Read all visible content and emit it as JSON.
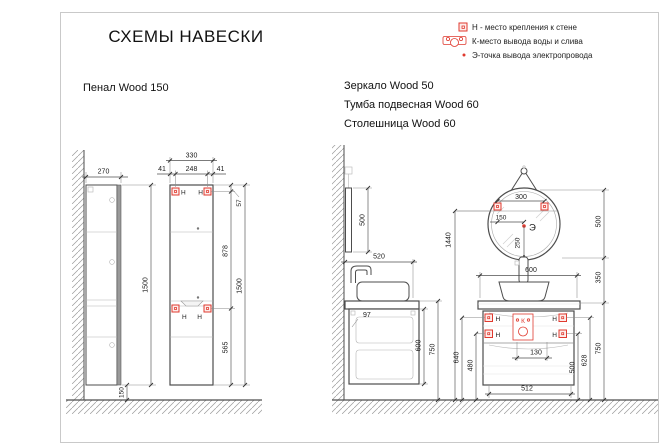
{
  "page": {
    "title": "СХЕМЫ НАВЕСКИ"
  },
  "legend": {
    "items": [
      {
        "name": "wall-mount",
        "label": "Н - место крепления к стене"
      },
      {
        "name": "water-outlet",
        "label": "К-место вывода воды и слива"
      },
      {
        "name": "electric-point",
        "label": "Э-точка вывода электропровода"
      }
    ]
  },
  "products": {
    "penal": "Пенал Wood 150",
    "mirror": "Зеркало Wood 50",
    "tumba": "Тумба подвесная Wood 60",
    "countertop": "Столешница Wood 60"
  },
  "markers": {
    "h": "Н",
    "k": "К",
    "e": "Э"
  },
  "dims": {
    "penal_side": {
      "depth": "270",
      "height": "1500",
      "floor_gap": "150"
    },
    "penal_front": {
      "width": "330",
      "edge_left": "41",
      "between_holes": "248",
      "edge_right": "41",
      "top_to_hole": "57",
      "hole_to_hole": "878",
      "hole_to_bottom": "565",
      "height": "1500"
    },
    "mirror": {
      "side_height": "500",
      "holes_span": "300",
      "hole_to_center": "150",
      "center_to_bottom": "250",
      "height": "500",
      "gap_below": "350",
      "floor_to_holes": "1440"
    },
    "tumba_side": {
      "counter_depth": "520",
      "back_inset": "97",
      "cabinet_height": "600",
      "floor_to_counter": "750"
    },
    "tumba_front": {
      "width": "600",
      "floor_to_upper_holes": "640",
      "floor_to_lower_holes": "480",
      "drain_width": "130",
      "bottom_width": "512",
      "floor_to_lower_holes_r": "500",
      "floor_to_upper_holes_r": "628",
      "floor_to_counter_r": "750"
    }
  },
  "colors": {
    "marker_red": "#e03a2f",
    "line_dark": "#4d4d4d"
  }
}
